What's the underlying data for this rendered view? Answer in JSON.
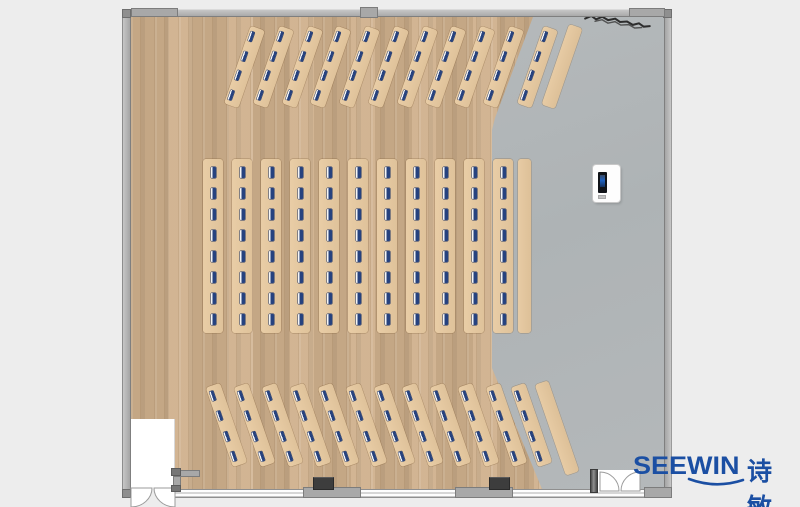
{
  "brand": {
    "logo_text_en": "SEEWIN",
    "logo_text_zh": "诗敏",
    "logo_color": "#1b4fa3"
  },
  "scene": {
    "type": "floor-plan",
    "colors": {
      "background": "#ededed",
      "wood_floor": "#cfb08c",
      "gray_floor": "#b2b7b9",
      "desk": "#e2c69f",
      "seat_marker_blue": "#26427f",
      "wall_gray": "#b6b6b6"
    },
    "furniture_summary": {
      "top_angled_rows": 11,
      "middle_columns": 11,
      "bottom_angled_rows": 12,
      "seats_per_angled_row": 4,
      "seats_per_middle_column": 8,
      "side_tables": 3,
      "podiums": 1,
      "total_seats": 180,
      "doors": 2
    }
  },
  "layout": {
    "canvas": {
      "w": 800,
      "h": 507
    },
    "sections": [
      {
        "name": "top-desk-rows",
        "kind": "slanted",
        "rot": 19,
        "cy": 67,
        "deskW": 15,
        "deskH": 82,
        "seats": 4,
        "centers": [
          244,
          273,
          302,
          330,
          359,
          388,
          417,
          445,
          474,
          503,
          537
        ]
      },
      {
        "name": "middle-desk-columns",
        "kind": "vertical",
        "rot": 0,
        "cy": 246,
        "deskW": 20,
        "deskH": 174,
        "seats": 8,
        "centers": [
          213,
          242,
          271,
          300,
          329,
          358,
          387,
          416,
          445,
          474,
          503
        ]
      },
      {
        "name": "bottom-desk-rows",
        "kind": "slanted",
        "rot": -19,
        "cy": 425,
        "deskW": 15,
        "deskH": 84,
        "seats": 4,
        "centers": [
          226,
          254,
          282,
          310,
          338,
          366,
          394,
          422,
          450,
          478,
          506,
          531
        ]
      }
    ],
    "side_tables": [
      {
        "cx": 562,
        "cy": 66,
        "w": 14,
        "h": 85,
        "rot": 19
      },
      {
        "cx": 524,
        "cy": 246,
        "w": 13,
        "h": 174,
        "rot": 0
      },
      {
        "cx": 557,
        "cy": 428,
        "w": 14,
        "h": 96,
        "rot": -19
      }
    ]
  }
}
